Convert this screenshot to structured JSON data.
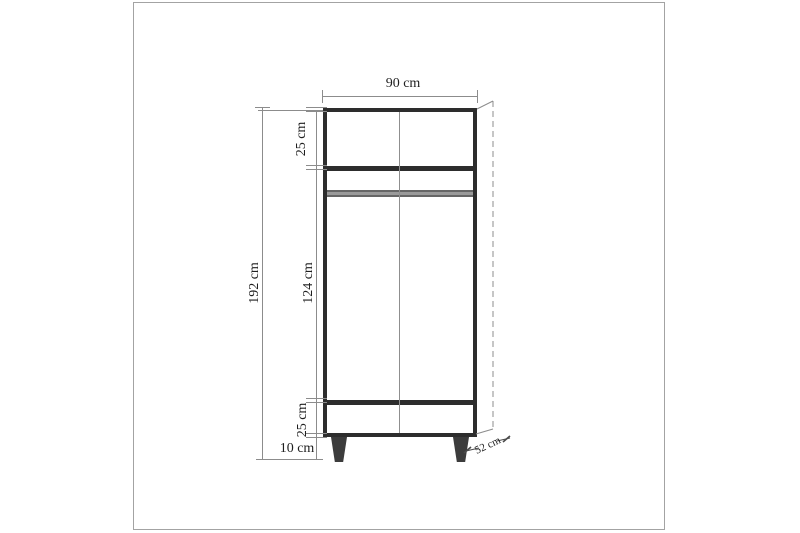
{
  "diagram": {
    "type": "furniture-technical-drawing",
    "subject": "two-door wardrobe front elevation with dimensions",
    "labels": {
      "width": "90 cm",
      "top_section_height": "25 cm",
      "total_height": "192 cm",
      "middle_section_height": "124 cm",
      "drawer_section_height": "25 cm",
      "leg_height": "10 cm",
      "depth": "52 cm"
    },
    "colors": {
      "frame_border": "#a3a3a3",
      "cabinet_outline": "#2d2d2d",
      "dimension_lines": "#8c8c8c",
      "hanging_rail": "#9a9a9a",
      "legs": "#3c3c3c",
      "text": "#1f1f1f"
    }
  }
}
